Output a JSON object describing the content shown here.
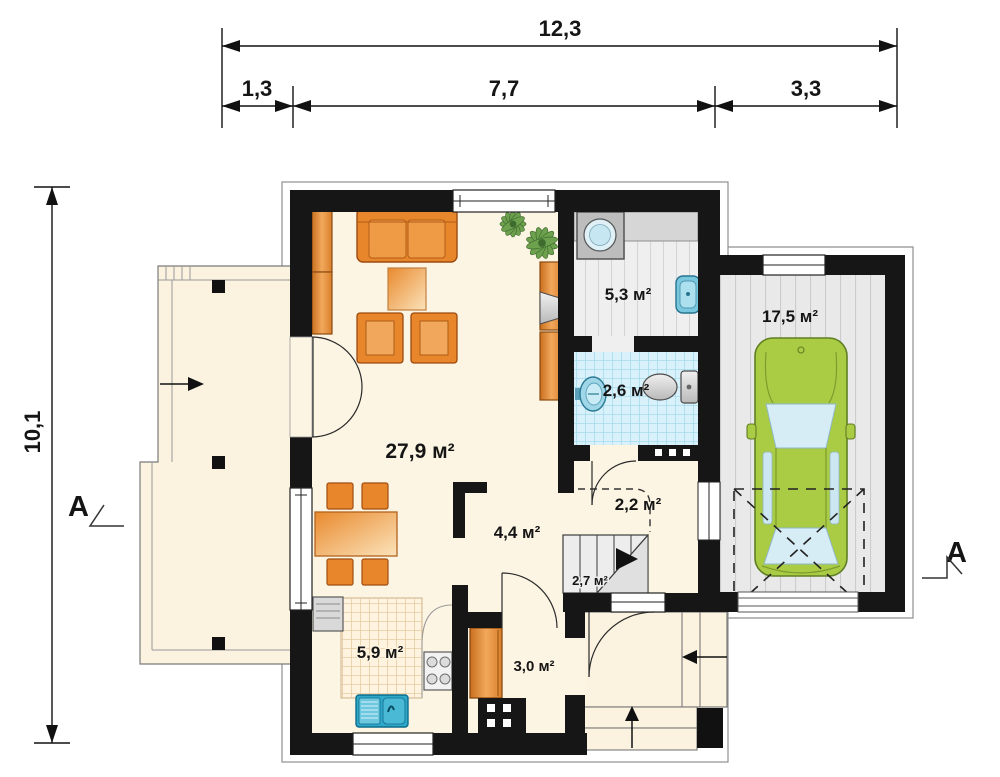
{
  "plan": {
    "title": "house-ground-floor-plan",
    "dims": {
      "total_w": "12,3",
      "seg1": "1,3",
      "seg2": "7,7",
      "seg3": "3,3",
      "total_h": "10,1"
    },
    "section": {
      "left": "A",
      "right": "A"
    },
    "rooms": {
      "living": "27,9 м²",
      "utility": "5,3 м²",
      "wc": "2,6 м²",
      "garage": "17,5 м²",
      "hall": "4,4 м²",
      "under_stairs": "2,2 м²",
      "stairs": "2,7 м²",
      "kitchen": "5,9 м²",
      "entry": "3,0 м²"
    },
    "colors": {
      "wall": "#161616",
      "floor_cream": "#fdf5e3",
      "furniture_orange": "#e8862b",
      "tile_blue": "#d9f1fb",
      "floor_gray": "#e9e9e9",
      "car_green": "#aacb44",
      "sink_blue": "#2fa7c9"
    }
  }
}
